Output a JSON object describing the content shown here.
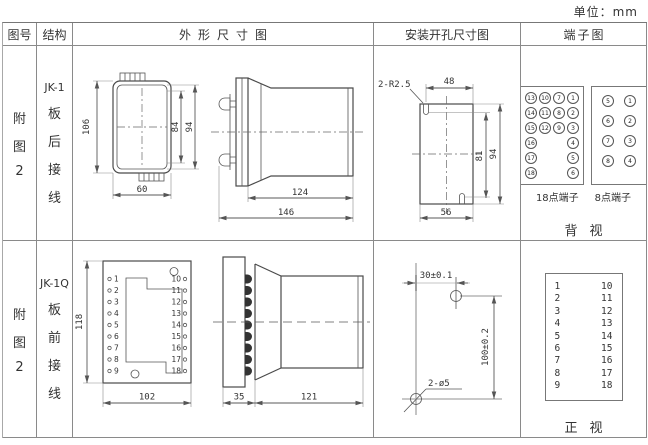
{
  "unit_label": "单位：mm",
  "header": {
    "col_fig_no": "图号",
    "col_structure": "结构",
    "col_outline": "外形尺寸图",
    "col_mounting": "安装开孔尺寸图",
    "col_terminal": "端子图"
  },
  "rows": [
    {
      "fig_no_lines": [
        "附",
        "图",
        "2"
      ],
      "structure_lines": [
        "JK-1",
        "板",
        "后",
        "接",
        "线"
      ],
      "outline": {
        "front": {
          "dim_height": "106",
          "dim_inner_height": "84",
          "dim_outer_height": "94",
          "dim_width": "60"
        },
        "side": {
          "dim_body_length": "124",
          "dim_total_length": "146"
        }
      },
      "mounting": {
        "slot_label": "2-R2.5",
        "dim_top_width": "48",
        "dim_slot_height": "81",
        "dim_height": "94",
        "dim_width": "56"
      },
      "terminals": {
        "grid18": [
          [
            "13",
            "10",
            "7",
            "1"
          ],
          [
            "14",
            "11",
            "8",
            "2"
          ],
          [
            "15",
            "12",
            "9",
            "3"
          ],
          [
            "16",
            "",
            "",
            "4"
          ],
          [
            "17",
            "",
            "",
            "5"
          ],
          [
            "18",
            "",
            "",
            "6"
          ]
        ],
        "grid8": [
          [
            "5",
            "1"
          ],
          [
            "6",
            "2"
          ],
          [
            "7",
            "3"
          ],
          [
            "8",
            "4"
          ]
        ],
        "label18": "18点端子",
        "label8": "8点端子",
        "view_label": "背视"
      }
    },
    {
      "fig_no_lines": [
        "附",
        "图",
        "2"
      ],
      "structure_lines": [
        "JK-1Q",
        "板",
        "前",
        "接",
        "线"
      ],
      "outline": {
        "front": {
          "left_terminals": [
            "1",
            "2",
            "3",
            "4",
            "5",
            "6",
            "7",
            "8",
            "9"
          ],
          "right_terminals": [
            "10",
            "11",
            "12",
            "13",
            "14",
            "15",
            "16",
            "17",
            "18"
          ],
          "dim_height": "118",
          "dim_width": "102"
        },
        "side": {
          "dim_panel": "35",
          "dim_body": "121"
        }
      },
      "mounting": {
        "dim_horizontal": "30±0.1",
        "dim_vertical": "100±0.2",
        "hole_label": "2-ø5"
      },
      "terminals": {
        "left": [
          "1",
          "2",
          "3",
          "4",
          "5",
          "6",
          "7",
          "8",
          "9"
        ],
        "right": [
          "10",
          "11",
          "12",
          "13",
          "14",
          "15",
          "16",
          "17",
          "18"
        ],
        "view_label": "正视"
      }
    }
  ]
}
